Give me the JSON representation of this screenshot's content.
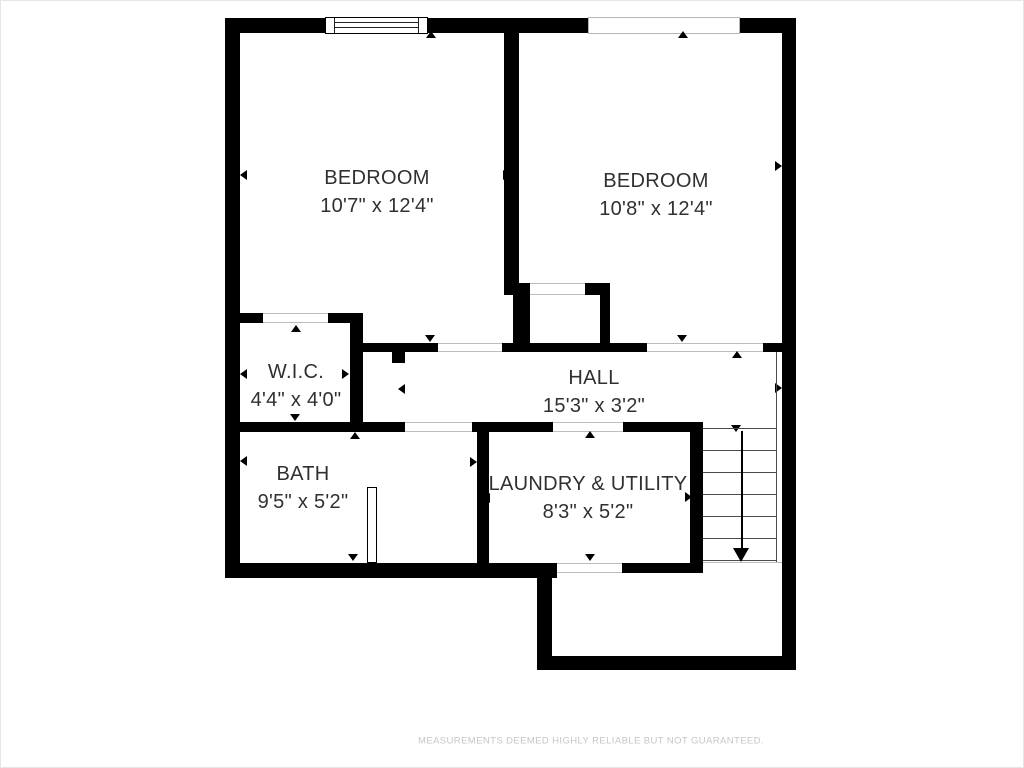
{
  "colors": {
    "wall": "#000000",
    "label_text": "#303030",
    "disclaimer_text": "#c6c6c6",
    "opening_edge": "#bdbdbd",
    "window_plain_edge": "#b5b5b5",
    "stair_line": "#4a4a4a"
  },
  "rooms": [
    {
      "id": "bedroom-left",
      "name": "BEDROOM",
      "dims": "10'7\" x 12'4\""
    },
    {
      "id": "bedroom-right",
      "name": "BEDROOM",
      "dims": "10'8\" x 12'4\""
    },
    {
      "id": "wic",
      "name": "W.I.C.",
      "dims": "4'4\" x 4'0\""
    },
    {
      "id": "hall",
      "name": "HALL",
      "dims": "15'3\" x 3'2\""
    },
    {
      "id": "bath",
      "name": "BATH",
      "dims": "9'5\" x 5'2\""
    },
    {
      "id": "laundry",
      "name": "LAUNDRY & UTILITY",
      "dims": "8'3\" x 5'2\""
    }
  ],
  "disclaimer": "MEASUREMENTS DEEMED HIGHLY RELIABLE BUT NOT GUARANTEED.",
  "floorplan": {
    "walls": [
      [
        225,
        18,
        571,
        15
      ],
      [
        225,
        18,
        15,
        560
      ],
      [
        782,
        18,
        14,
        652
      ],
      [
        225,
        563,
        332,
        15
      ],
      [
        537,
        563,
        15,
        107
      ],
      [
        537,
        656,
        259,
        14
      ],
      [
        504,
        18,
        15,
        277
      ],
      [
        513,
        283,
        17,
        60
      ],
      [
        585,
        283,
        25,
        12
      ],
      [
        600,
        295,
        10,
        48
      ],
      [
        350,
        343,
        88,
        9
      ],
      [
        502,
        343,
        145,
        9
      ],
      [
        763,
        343,
        19,
        9
      ],
      [
        392,
        352,
        13,
        11
      ],
      [
        225,
        313,
        38,
        10
      ],
      [
        328,
        313,
        35,
        10
      ],
      [
        350,
        313,
        13,
        119
      ],
      [
        225,
        422,
        180,
        10
      ],
      [
        472,
        422,
        81,
        10
      ],
      [
        623,
        422,
        80,
        10
      ],
      [
        477,
        422,
        12,
        141
      ],
      [
        690,
        422,
        13,
        151
      ],
      [
        622,
        563,
        81,
        10
      ]
    ],
    "openings": [
      [
        530,
        283,
        55,
        12
      ],
      [
        438,
        343,
        64,
        9
      ],
      [
        647,
        343,
        116,
        9
      ],
      [
        263,
        313,
        65,
        10
      ],
      [
        405,
        422,
        67,
        10
      ],
      [
        553,
        422,
        70,
        10
      ],
      [
        557,
        563,
        65,
        10
      ]
    ],
    "windows": [
      {
        "type": "framed",
        "rect": [
          325,
          17,
          103,
          17
        ]
      },
      {
        "type": "plain",
        "rect": [
          588,
          17,
          152,
          17
        ]
      }
    ],
    "arrows": [
      [
        431,
        34,
        "up"
      ],
      [
        430,
        339,
        "down"
      ],
      [
        244,
        175,
        "left"
      ],
      [
        506,
        175,
        "right"
      ],
      [
        683,
        34,
        "up"
      ],
      [
        682,
        339,
        "down"
      ],
      [
        516,
        167,
        "left"
      ],
      [
        778,
        166,
        "right"
      ],
      [
        296,
        328,
        "up"
      ],
      [
        295,
        418,
        "down"
      ],
      [
        244,
        374,
        "left"
      ],
      [
        345,
        374,
        "right"
      ],
      [
        402,
        389,
        "left"
      ],
      [
        778,
        388,
        "right"
      ],
      [
        737,
        354,
        "up"
      ],
      [
        736,
        429,
        "down"
      ],
      [
        355,
        435,
        "up"
      ],
      [
        353,
        558,
        "down"
      ],
      [
        244,
        461,
        "left"
      ],
      [
        473,
        462,
        "right"
      ],
      [
        590,
        434,
        "up"
      ],
      [
        590,
        558,
        "down"
      ],
      [
        487,
        498,
        "left"
      ],
      [
        688,
        497,
        "right"
      ]
    ],
    "stairs": {
      "tread_ys": [
        428,
        450,
        472,
        494,
        516,
        538,
        560
      ],
      "tread_x1": 703,
      "tread_x2": 776,
      "edge_line": {
        "x": 776,
        "y1": 352,
        "y2": 562
      },
      "bottom_line": {
        "y": 562,
        "x1": 703,
        "x2": 782
      },
      "arrow_shaft": {
        "x": 741,
        "y1": 431,
        "y2": 550
      },
      "arrow_head": {
        "cx": 741,
        "y": 548
      }
    },
    "fixtures": [
      {
        "id": "bath-door-leaf",
        "rect": [
          367,
          487,
          10,
          76
        ]
      }
    ]
  }
}
